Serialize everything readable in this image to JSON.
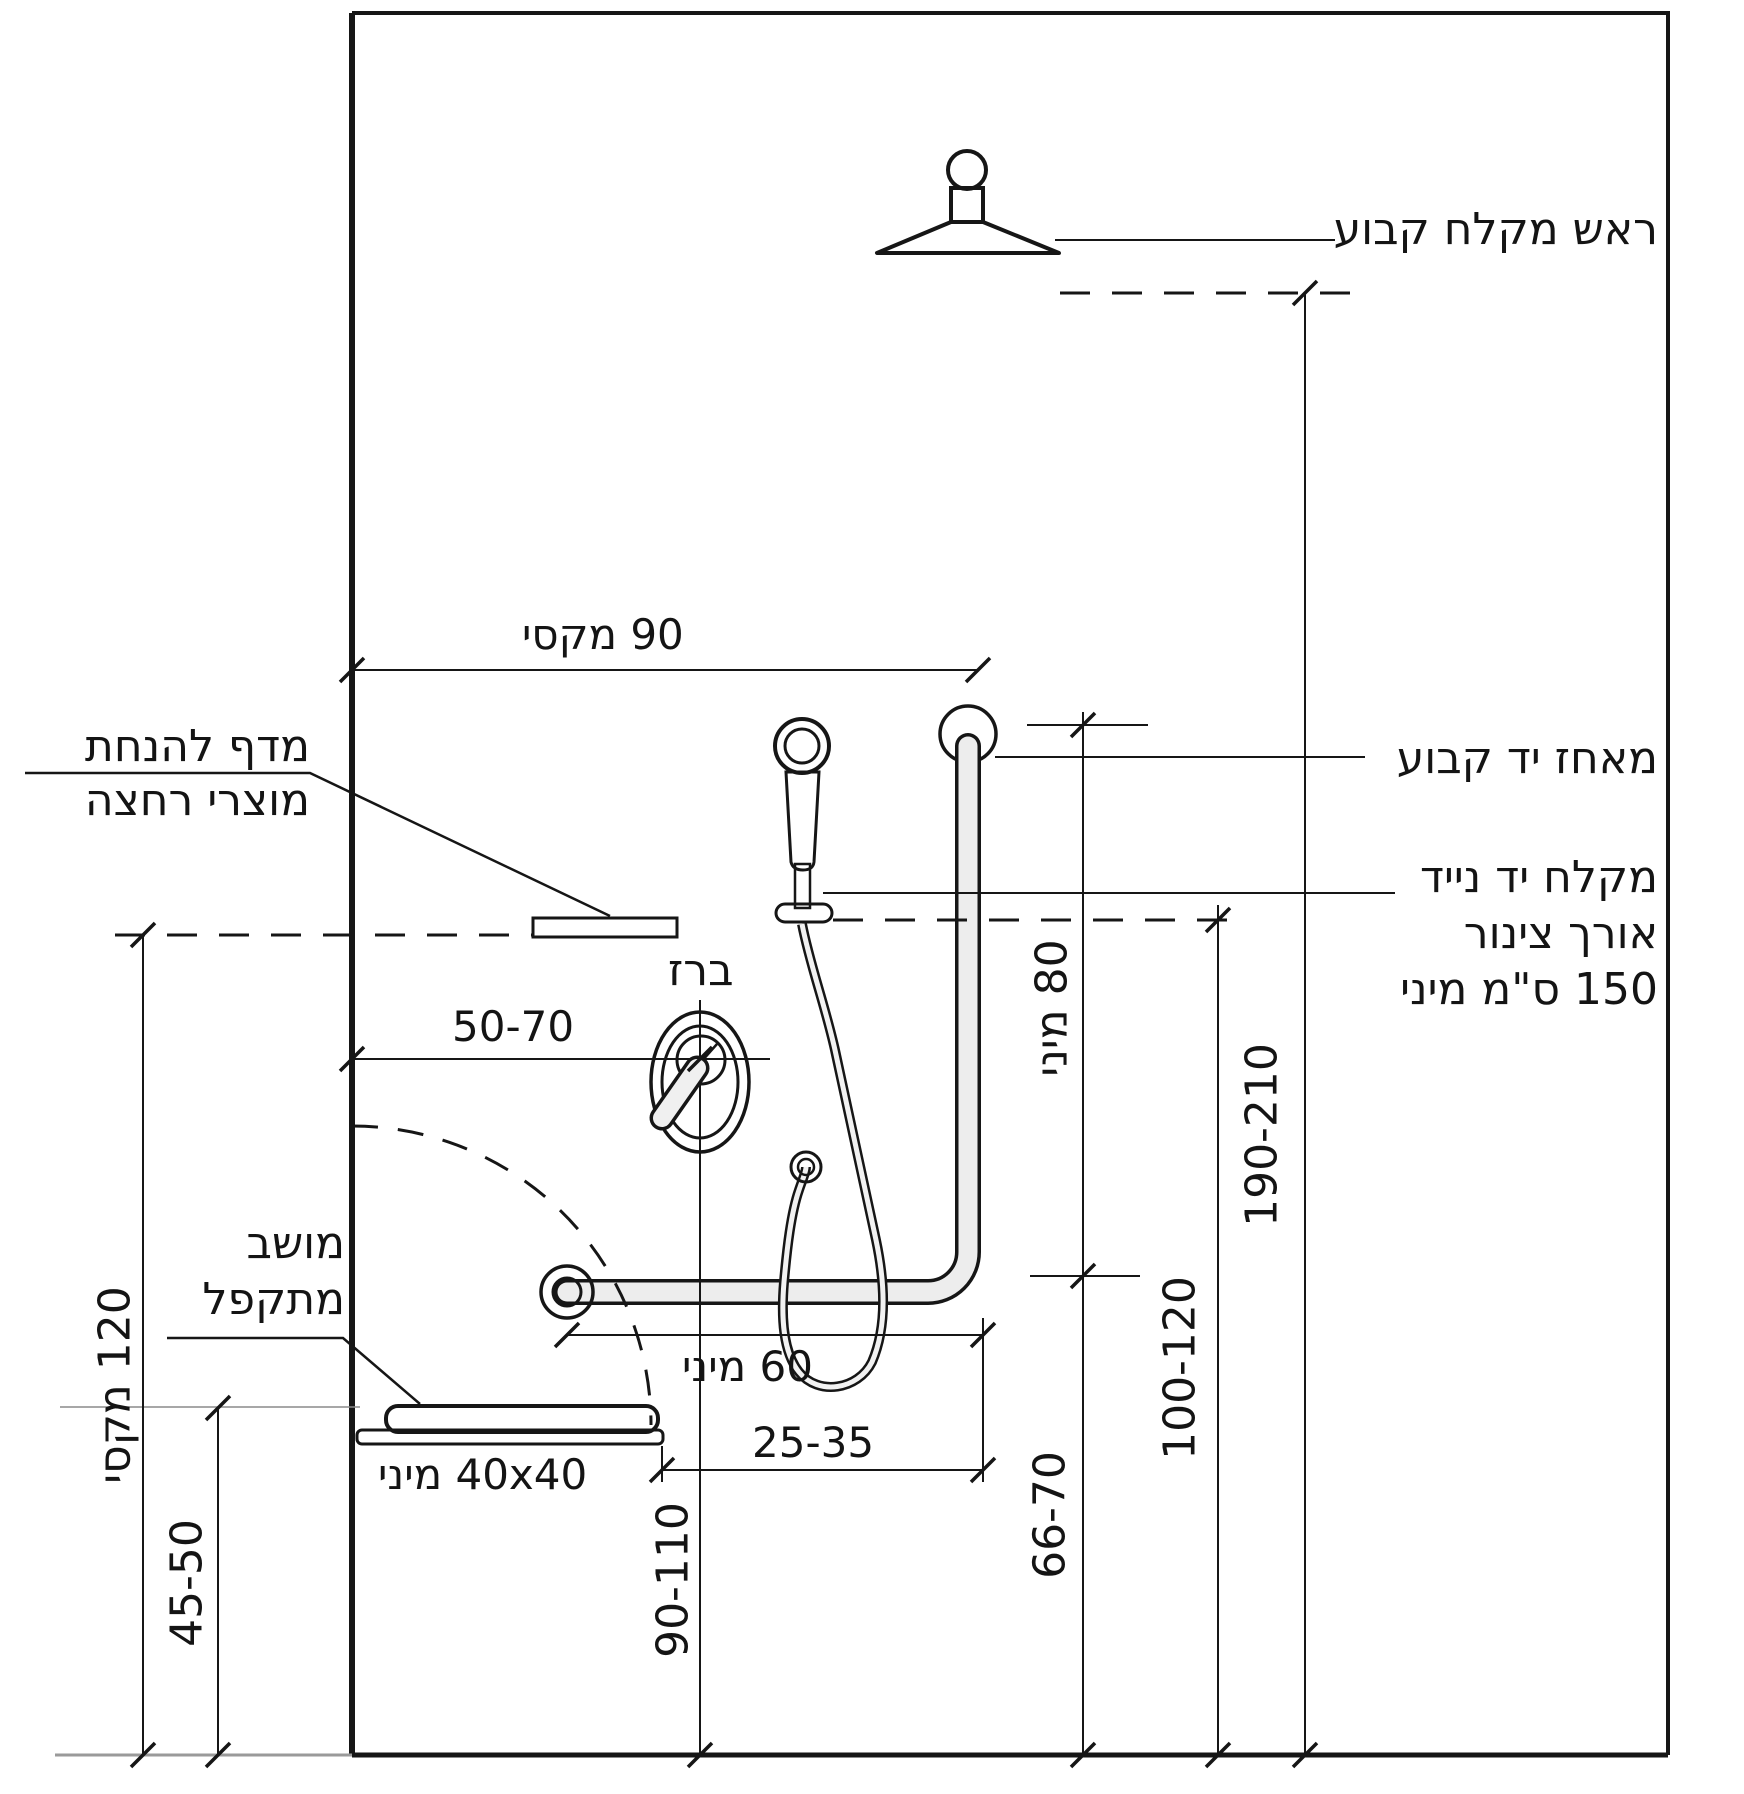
{
  "diagram": {
    "title": "תרשים התקנה נגישה של מקלחת",
    "labels": {
      "fixed_shower_head": "ראש מקלח קבוע",
      "fixed_grab_bar": "מאחז יד קבוע",
      "hand_shower_line1": "מקלח יד נייד",
      "hand_shower_line2": "אורך צינור",
      "hand_shower_line3": "150 ס\"מ מיני",
      "shelf_line1": "מדף להנחת",
      "shelf_line2": "מוצרי רחצה",
      "faucet": "ברז",
      "seat_line1": "מושב",
      "seat_line2": "מתקפל"
    },
    "dimensions": {
      "top_width_max": "90 מקסי",
      "faucet_offset": "50-70",
      "bar_length_min": "60 מיני",
      "seat_to_bar": "25-35",
      "seat_size_min": "40x40 מיני",
      "faucet_height": "90-110",
      "seat_height": "45-50",
      "shelf_height_max": "120 מקסי",
      "vertical_bar_min": "80 מיני",
      "bar_height": "66-70",
      "hand_shower_height": "100-120",
      "head_height": "190-210"
    },
    "line_color": "#161616",
    "fixture_fill": "#ececec"
  }
}
